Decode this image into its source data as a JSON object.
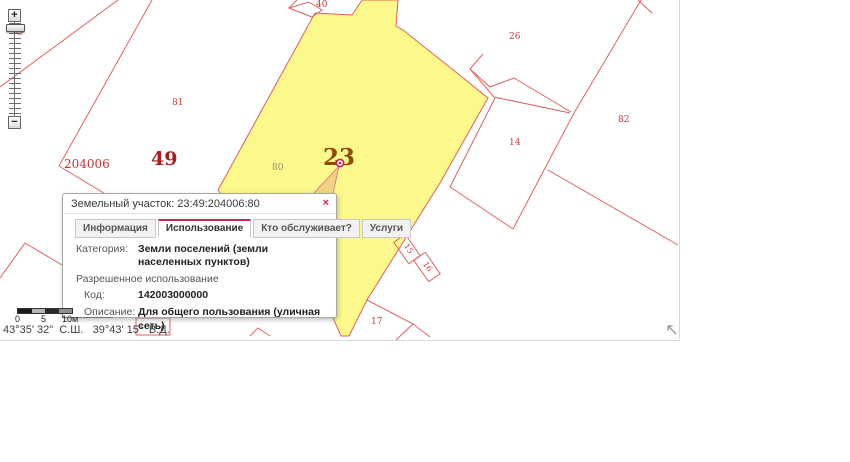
{
  "popup": {
    "title": "Земельный участок: 23:49:204006:80",
    "close_label": "×",
    "tabs": [
      {
        "label": "Информация"
      },
      {
        "label": "Использование"
      },
      {
        "label": "Кто обслуживает?"
      },
      {
        "label": "Услуги"
      }
    ],
    "category_label": "Категория:",
    "category_value": "Земли поселений (земли населенных пунктов)",
    "permitted_use_heading": "Разрешенное использование",
    "code_label": "Код:",
    "code_value": "142003000000",
    "description_label": "Описание:",
    "description_value": "Для общего пользования (уличная сеть)"
  },
  "map": {
    "parcel_labels": [
      {
        "text": "40"
      },
      {
        "text": "26"
      },
      {
        "text": "81"
      },
      {
        "text": "82"
      },
      {
        "text": "14"
      },
      {
        "text": "204006"
      },
      {
        "text": "49"
      },
      {
        "text": "80"
      },
      {
        "text": "23"
      },
      {
        "text": "17"
      },
      {
        "text": "15"
      },
      {
        "text": "16"
      }
    ],
    "colors": {
      "parcel_line": "#e06060",
      "selected_parcel_fill": "#fcf88c",
      "label_red": "#c23b3b",
      "label_dark_red": "#a81f1f",
      "selected_label_brown": "#944806",
      "sub_label_olive": "#97916f",
      "accent_crimson": "#c22a52"
    }
  },
  "zoom_control": {
    "zoom_in_label": "+",
    "zoom_out_label": "−"
  },
  "scale_bar": {
    "tick_labels": [
      "0",
      "5",
      "10м"
    ]
  },
  "status_bar": {
    "coordinates": "43°35' 32\"  С.Ш.   39°43' 15\"  В.Д."
  }
}
